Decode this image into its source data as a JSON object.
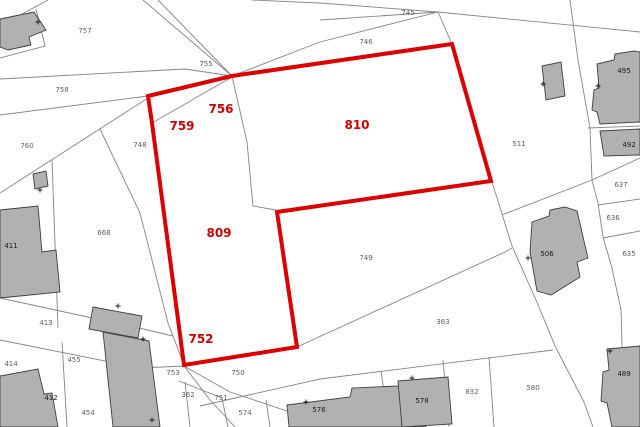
{
  "map": {
    "width": 640,
    "height": 427,
    "background": "#ffffff",
    "colors": {
      "boundary": "#858585",
      "building_fill": "#b1b1b1",
      "building_stroke": "#3f3f3f",
      "highlight": "#dd0000",
      "parcel_label": "#5f5f5f",
      "building_label": "#1a1a1a",
      "marker": "#1a1a1a"
    },
    "highlight_outline": {
      "stroke_width": 4,
      "points": [
        [
          148,
          96
        ],
        [
          232,
          76
        ],
        [
          452,
          44
        ],
        [
          491,
          181
        ],
        [
          277,
          212
        ],
        [
          297,
          347
        ],
        [
          184,
          365
        ],
        [
          152,
          123
        ]
      ]
    },
    "highlighted_parcel_labels": [
      {
        "text": "756",
        "x": 221,
        "y": 113
      },
      {
        "text": "759",
        "x": 182,
        "y": 130
      },
      {
        "text": "810",
        "x": 357,
        "y": 129
      },
      {
        "text": "809",
        "x": 219,
        "y": 237
      },
      {
        "text": "752",
        "x": 201,
        "y": 343
      }
    ],
    "parcel_labels": [
      {
        "text": "757",
        "x": 85,
        "y": 33
      },
      {
        "text": "758",
        "x": 62,
        "y": 92
      },
      {
        "text": "760",
        "x": 27,
        "y": 148
      },
      {
        "text": "748",
        "x": 140,
        "y": 147
      },
      {
        "text": "755",
        "x": 206,
        "y": 66
      },
      {
        "text": "745",
        "x": 408,
        "y": 15
      },
      {
        "text": "746",
        "x": 366,
        "y": 44
      },
      {
        "text": "511",
        "x": 519,
        "y": 146
      },
      {
        "text": "637",
        "x": 621,
        "y": 187
      },
      {
        "text": "636",
        "x": 613,
        "y": 220
      },
      {
        "text": "635",
        "x": 629,
        "y": 256
      },
      {
        "text": "668",
        "x": 104,
        "y": 235
      },
      {
        "text": "749",
        "x": 366,
        "y": 260
      },
      {
        "text": "363",
        "x": 443,
        "y": 324
      },
      {
        "text": "413",
        "x": 46,
        "y": 325
      },
      {
        "text": "414",
        "x": 11,
        "y": 366
      },
      {
        "text": "455",
        "x": 74,
        "y": 362
      },
      {
        "text": "753",
        "x": 173,
        "y": 375
      },
      {
        "text": "750",
        "x": 238,
        "y": 375
      },
      {
        "text": "362",
        "x": 188,
        "y": 397
      },
      {
        "text": "751",
        "x": 221,
        "y": 400
      },
      {
        "text": "574",
        "x": 245,
        "y": 415
      },
      {
        "text": "454",
        "x": 88,
        "y": 415
      },
      {
        "text": "832",
        "x": 472,
        "y": 394
      },
      {
        "text": "580",
        "x": 533,
        "y": 390
      }
    ],
    "building_labels": [
      {
        "text": "411",
        "x": 11,
        "y": 248
      },
      {
        "text": "412",
        "x": 51,
        "y": 400
      },
      {
        "text": "495",
        "x": 624,
        "y": 73
      },
      {
        "text": "492",
        "x": 629,
        "y": 147
      },
      {
        "text": "506",
        "x": 547,
        "y": 256
      },
      {
        "text": "576",
        "x": 319,
        "y": 412
      },
      {
        "text": "578",
        "x": 422,
        "y": 403
      },
      {
        "text": "489",
        "x": 624,
        "y": 376
      }
    ],
    "boundary_lines": [
      {
        "points": [
          [
            0,
            26
          ],
          [
            48,
            0
          ]
        ]
      },
      {
        "points": [
          [
            0,
            58
          ],
          [
            45,
            46
          ],
          [
            36,
            9
          ]
        ]
      },
      {
        "points": [
          [
            0,
            79
          ],
          [
            185,
            69
          ],
          [
            232,
            76
          ]
        ]
      },
      {
        "points": [
          [
            143,
            0
          ],
          [
            232,
            76
          ]
        ]
      },
      {
        "points": [
          [
            158,
            0
          ],
          [
            232,
            76
          ]
        ]
      },
      {
        "points": [
          [
            0,
            115
          ],
          [
            148,
            96
          ]
        ]
      },
      {
        "points": [
          [
            0,
            193
          ],
          [
            148,
            98
          ]
        ]
      },
      {
        "points": [
          [
            100,
            129
          ],
          [
            140,
            213
          ],
          [
            168,
            323
          ],
          [
            184,
            365
          ]
        ]
      },
      {
        "points": [
          [
            52,
            160
          ],
          [
            58,
            328
          ]
        ]
      },
      {
        "points": [
          [
            0,
            298
          ],
          [
            143,
            329
          ],
          [
            173,
            336
          ]
        ]
      },
      {
        "points": [
          [
            0,
            340
          ],
          [
            140,
            368
          ],
          [
            184,
            366
          ]
        ]
      },
      {
        "points": [
          [
            62,
            342
          ],
          [
            67,
            427
          ]
        ]
      },
      {
        "points": [
          [
            0,
            379
          ],
          [
            48,
            399
          ]
        ]
      },
      {
        "points": [
          [
            184,
            366
          ],
          [
            230,
            392
          ],
          [
            290,
            412
          ],
          [
            350,
            427
          ]
        ]
      },
      {
        "points": [
          [
            179,
            381
          ],
          [
            222,
            398
          ]
        ]
      },
      {
        "points": [
          [
            185,
            382
          ],
          [
            190,
            427
          ]
        ]
      },
      {
        "points": [
          [
            222,
            398
          ],
          [
            228,
            427
          ]
        ]
      },
      {
        "points": [
          [
            184,
            366
          ],
          [
            210,
            400
          ],
          [
            235,
            427
          ]
        ]
      },
      {
        "points": [
          [
            266,
            400
          ],
          [
            270,
            427
          ]
        ]
      },
      {
        "points": [
          [
            381,
            371
          ],
          [
            389,
            427
          ]
        ]
      },
      {
        "points": [
          [
            443,
            360
          ],
          [
            449,
            427
          ]
        ]
      },
      {
        "points": [
          [
            489,
            357
          ],
          [
            494,
            427
          ]
        ]
      },
      {
        "points": [
          [
            200,
            406
          ],
          [
            320,
            379
          ],
          [
            553,
            350
          ]
        ]
      },
      {
        "points": [
          [
            297,
            347
          ],
          [
            505,
            252
          ],
          [
            512,
            248
          ]
        ]
      },
      {
        "points": [
          [
            492,
            182
          ],
          [
            502,
            214
          ],
          [
            512,
            246
          ],
          [
            536,
            300
          ],
          [
            556,
            348
          ],
          [
            584,
            402
          ],
          [
            593,
            427
          ]
        ]
      },
      {
        "points": [
          [
            502,
            215
          ],
          [
            592,
            180
          ],
          [
            640,
            158
          ]
        ]
      },
      {
        "points": [
          [
            592,
            180
          ],
          [
            598,
            203
          ],
          [
            603,
            237
          ],
          [
            612,
            268
          ],
          [
            621,
            310
          ],
          [
            623,
            377
          ]
        ]
      },
      {
        "points": [
          [
            598,
            205
          ],
          [
            640,
            199
          ]
        ]
      },
      {
        "points": [
          [
            603,
            238
          ],
          [
            640,
            231
          ]
        ]
      },
      {
        "points": [
          [
            570,
            0
          ],
          [
            578,
            60
          ],
          [
            590,
            128
          ],
          [
            592,
            180
          ]
        ]
      },
      {
        "points": [
          [
            588,
            128
          ],
          [
            640,
            126
          ]
        ]
      },
      {
        "points": [
          [
            252,
            0
          ],
          [
            320,
            3
          ],
          [
            438,
            12
          ],
          [
            640,
            32
          ]
        ]
      },
      {
        "points": [
          [
            320,
            20
          ],
          [
            438,
            12
          ]
        ]
      },
      {
        "points": [
          [
            232,
            76
          ],
          [
            320,
            42
          ],
          [
            438,
            12
          ]
        ]
      },
      {
        "points": [
          [
            438,
            12
          ],
          [
            452,
            44
          ]
        ]
      },
      {
        "points": [
          [
            152,
            123
          ],
          [
            232,
            77
          ]
        ]
      },
      {
        "points": [
          [
            232,
            76
          ],
          [
            247,
            142
          ],
          [
            253,
            206
          ],
          [
            276,
            210
          ]
        ]
      }
    ],
    "buildings": [
      {
        "points": [
          [
            0,
            19
          ],
          [
            34,
            12
          ],
          [
            46,
            30
          ],
          [
            29,
            37
          ],
          [
            31,
            45
          ],
          [
            8,
            50
          ],
          [
            0,
            47
          ]
        ]
      },
      {
        "points": [
          [
            33,
            174
          ],
          [
            46,
            171
          ],
          [
            48,
            186
          ],
          [
            35,
            189
          ]
        ]
      },
      {
        "points": [
          [
            0,
            210
          ],
          [
            38,
            206
          ],
          [
            42,
            252
          ],
          [
            56,
            250
          ],
          [
            60,
            292
          ],
          [
            0,
            298
          ]
        ]
      },
      {
        "points": [
          [
            93,
            307
          ],
          [
            142,
            316
          ],
          [
            138,
            338
          ],
          [
            89,
            329
          ]
        ]
      },
      {
        "points": [
          [
            103,
            332
          ],
          [
            149,
            341
          ],
          [
            160,
            427
          ],
          [
            113,
            427
          ]
        ]
      },
      {
        "points": [
          [
            0,
            376
          ],
          [
            38,
            369
          ],
          [
            44,
            394
          ],
          [
            52,
            393
          ],
          [
            58,
            427
          ],
          [
            0,
            427
          ]
        ]
      },
      {
        "points": [
          [
            287,
            405
          ],
          [
            350,
            397
          ],
          [
            352,
            388
          ],
          [
            421,
            385
          ],
          [
            426,
            427
          ],
          [
            289,
            427
          ]
        ]
      },
      {
        "points": [
          [
            398,
            381
          ],
          [
            448,
            377
          ],
          [
            452,
            424
          ],
          [
            402,
            427
          ]
        ]
      },
      {
        "points": [
          [
            607,
            349
          ],
          [
            640,
            346
          ],
          [
            640,
            427
          ],
          [
            612,
            427
          ],
          [
            607,
            403
          ],
          [
            601,
            401
          ],
          [
            603,
            372
          ],
          [
            609,
            370
          ]
        ]
      },
      {
        "points": [
          [
            532,
            222
          ],
          [
            549,
            216
          ],
          [
            550,
            210
          ],
          [
            565,
            207
          ],
          [
            577,
            211
          ],
          [
            588,
            258
          ],
          [
            577,
            262
          ],
          [
            580,
            277
          ],
          [
            551,
            295
          ],
          [
            537,
            291
          ],
          [
            530,
            252
          ]
        ]
      },
      {
        "points": [
          [
            597,
            64
          ],
          [
            614,
            60
          ],
          [
            615,
            54
          ],
          [
            634,
            51
          ],
          [
            640,
            52
          ],
          [
            640,
            122
          ],
          [
            600,
            124
          ],
          [
            597,
            112
          ],
          [
            592,
            110
          ],
          [
            594,
            90
          ],
          [
            599,
            88
          ]
        ]
      },
      {
        "points": [
          [
            600,
            131
          ],
          [
            640,
            129
          ],
          [
            640,
            155
          ],
          [
            604,
            156
          ]
        ]
      },
      {
        "points": [
          [
            542,
            66
          ],
          [
            561,
            62
          ],
          [
            565,
            96
          ],
          [
            546,
            100
          ]
        ]
      }
    ],
    "corner_markers": [
      [
        38,
        22
      ],
      [
        40,
        190
      ],
      [
        118,
        306
      ],
      [
        143,
        339
      ],
      [
        152,
        420
      ],
      [
        306,
        402
      ],
      [
        412,
        378
      ],
      [
        528,
        258
      ],
      [
        543,
        84
      ],
      [
        598,
        86
      ],
      [
        610,
        351
      ]
    ]
  }
}
